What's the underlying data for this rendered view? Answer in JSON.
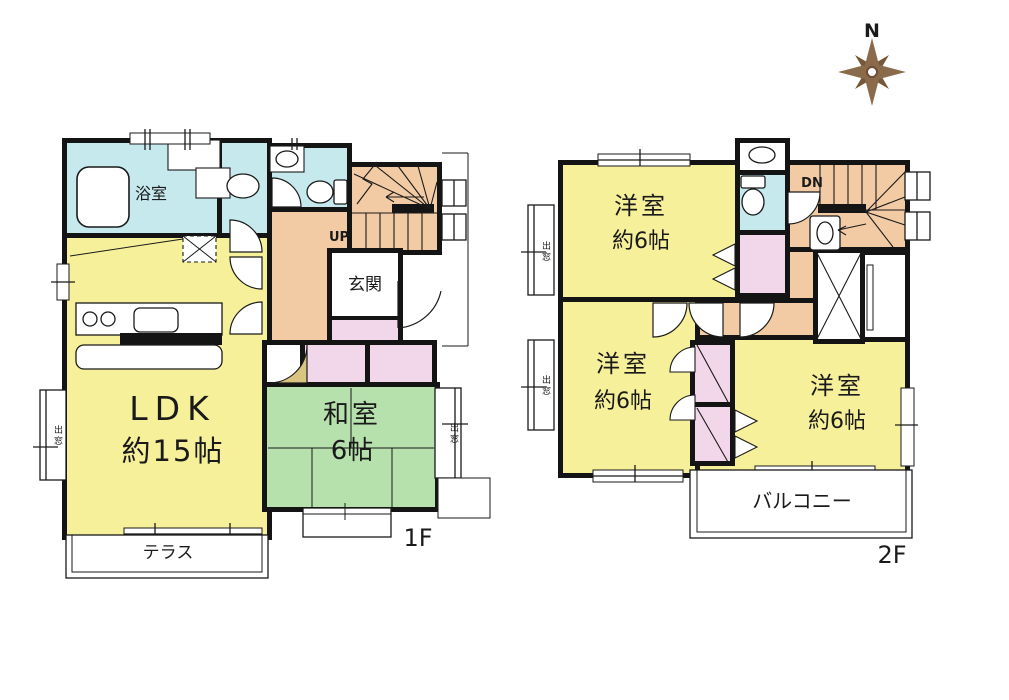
{
  "compass": {
    "north": "N"
  },
  "floor_1f": {
    "name": "1F",
    "bathroom": "浴室",
    "stairs": "UP",
    "entrance": "玄関",
    "ldk": "LDK",
    "ldk_size": "約15帖",
    "washitsu": "和室",
    "washitsu_size": "6帖",
    "terrace": "テラス",
    "bay_window": "出窓"
  },
  "floor_2f": {
    "name": "2F",
    "stairs": "DN",
    "bedroom_top": "洋室",
    "bedroom_top_size": "約6帖",
    "bedroom_left": "洋室",
    "bedroom_left_size": "約6帖",
    "bedroom_right": "洋室",
    "bedroom_right_size": "約6帖",
    "balcony": "バルコニー",
    "bay_window": "出窓"
  },
  "colors": {
    "wall": "#141414",
    "room_yellow": "#f7f09a",
    "tatami_green": "#b6e1ad",
    "wet_area_blue": "#c6e9ee",
    "hall_stairs_tan": "#f2cba4",
    "closet_pink": "#f2d6ea",
    "entry_mat_khaki": "#d9c57f",
    "compass_brown": "#8a6a4a"
  }
}
